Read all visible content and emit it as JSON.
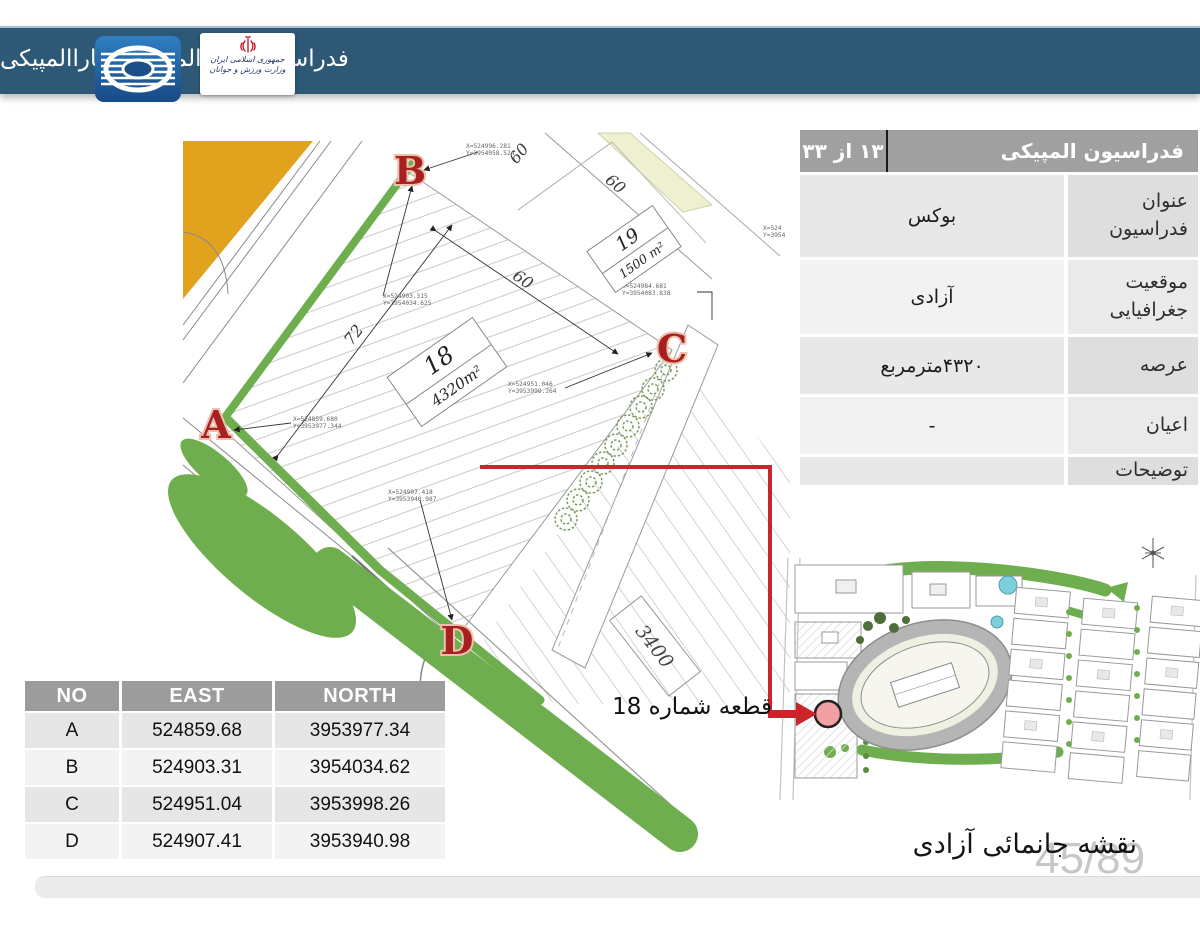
{
  "header": {
    "title": "فدراسیون های المپیکی و پاراالمپیکی",
    "ministry_badge": {
      "line1": "جمهوری اسلامی ایران",
      "line2": "وزارت ورزش و جوانان"
    }
  },
  "info_table": {
    "title": "فدراسیون المپیکی",
    "counter": "۱۳ از ۳۳",
    "rows": [
      {
        "label": "عنوان فدراسیون",
        "value": "بوکس"
      },
      {
        "label": "موقعیت جغرافیایی",
        "value": "آزادی"
      },
      {
        "label": "عرصه",
        "value": "۴۳۲۰مترمربع"
      },
      {
        "label": "اعیان",
        "value": "-"
      },
      {
        "label": "توضیحات",
        "value": ""
      }
    ]
  },
  "coords_table": {
    "headers": [
      "NO",
      "EAST",
      "NORTH"
    ],
    "rows": [
      [
        "A",
        "524859.68",
        "3953977.34"
      ],
      [
        "B",
        "524903.31",
        "3954034.62"
      ],
      [
        "C",
        "524951.04",
        "3953998.26"
      ],
      [
        "D",
        "524907.41",
        "3953940.98"
      ]
    ]
  },
  "drawing": {
    "corner_labels": [
      "A",
      "B",
      "C",
      "D"
    ],
    "plot18": {
      "number": "18",
      "area": "4320m²"
    },
    "plot19": {
      "number": "19",
      "area": "1500 m²"
    },
    "road_number": "3400",
    "dims": [
      "72",
      "60",
      "60",
      "60"
    ],
    "annotations": [
      {
        "line1": "X=524996.281",
        "line2": "Y=3954058.524"
      },
      {
        "line1": "X=524903.315",
        "line2": "Y=3954034.625"
      },
      {
        "line1": "X=524951.046",
        "line2": "Y=3953998.264"
      },
      {
        "line1": "X=524859.680",
        "line2": "Y=3953977.344"
      },
      {
        "line1": "X=524907.418",
        "line2": "Y=3953940.987"
      },
      {
        "line1": "X=524984.681",
        "line2": "Y=3954083.838"
      },
      {
        "line1": "X=524",
        "line2": "Y=3954"
      }
    ]
  },
  "site_map": {
    "marker_caption": "قطعه شماره 18"
  },
  "footer": {
    "caption": "نقشه جانمائی آزادی",
    "page": "45/89"
  },
  "colors": {
    "header_blue": "#2d5876",
    "accent_red": "#c9252b",
    "block_orange": "#e1a21e",
    "green": "#6fae4e",
    "table_gray": "#9c9c9c"
  }
}
